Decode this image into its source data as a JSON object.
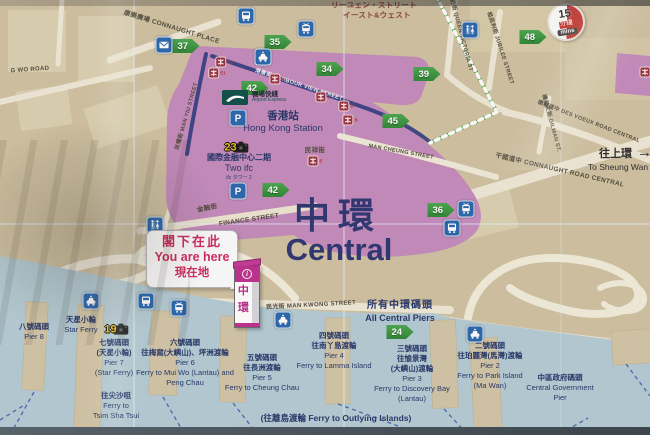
{
  "title": {
    "zh": "中環",
    "en": "Central"
  },
  "you_are_here": {
    "zh": "閣下在此",
    "en": "You are here",
    "jp": "現在地"
  },
  "pillar": {
    "info": "i",
    "char1": "中",
    "char2": "環"
  },
  "sheung_wan": {
    "zh": "往上環",
    "arrow": "→",
    "en": "To Sheung Wan"
  },
  "all_piers": {
    "zh": "所有中環碼頭",
    "en": "All Central Piers"
  },
  "walk_logo": {
    "big": "15",
    "zh": "分鐘",
    "en": "mins"
  },
  "airport_express": {
    "zh": "機場快綫",
    "en": "Airport Express"
  },
  "station": {
    "zh": "香港站",
    "en": "Hong Kong Station"
  },
  "two_ifc": {
    "zh": "國際金融中心二期",
    "en": "Two ifc",
    "jp": "ifc タワー 2"
  },
  "street_labels": [
    {
      "t": "康樂廣場 CONNAUGHT PLACE",
      "x": 172,
      "y": 26,
      "r": 17,
      "s": 6.5
    },
    {
      "t": "リーユェン・ストリート",
      "x": 374,
      "y": 5,
      "r": 0,
      "s": 7.5,
      "cls": "jp"
    },
    {
      "t": "イースト&ウェスト",
      "x": 377,
      "y": 15,
      "r": 0,
      "s": 7.5,
      "cls": "jp"
    },
    {
      "t": "域多利皇后街 QUEEN VICTORIA ST",
      "x": 459,
      "y": 24,
      "r": 75,
      "s": 5.5
    },
    {
      "t": "租庇利街 JUBILEE STREET",
      "x": 501,
      "y": 48,
      "r": 72,
      "s": 5.5
    },
    {
      "t": "德輔道中",
      "x": 578,
      "y": 22,
      "r": 78,
      "s": 5.5
    },
    {
      "t": "德輔道中 DES VOEUX ROAD CENTRAL",
      "x": 589,
      "y": 121,
      "r": 21,
      "s": 5.5
    },
    {
      "t": "機利文街 GILMAN ST.",
      "x": 552,
      "y": 123,
      "r": 75,
      "s": 5.5
    },
    {
      "t": "干諾道中 CONNAUGHT ROAD CENTRAL",
      "x": 560,
      "y": 169,
      "r": 13,
      "s": 6.5
    },
    {
      "t": "港景街 HARBOUR VIEW STREET",
      "x": 299,
      "y": 84,
      "r": 18,
      "s": 5.5,
      "cls": "onband"
    },
    {
      "t": "民耀街 MAN YIU STREET",
      "x": 186,
      "y": 116,
      "r": -74,
      "s": 5.5
    },
    {
      "t": "民祥街",
      "x": 315,
      "y": 149,
      "r": 0,
      "s": 6.5
    },
    {
      "t": "MAN CHEUNG STREET",
      "x": 401,
      "y": 152,
      "r": 10,
      "s": 5.5
    },
    {
      "t": "金融街",
      "x": 207,
      "y": 207,
      "r": -12,
      "s": 6.5
    },
    {
      "t": "FINANCE STREET",
      "x": 249,
      "y": 220,
      "r": -8,
      "s": 6.5
    },
    {
      "t": "民光街 MAN KWONG STREET",
      "x": 311,
      "y": 304,
      "r": -3,
      "s": 6
    },
    {
      "t": "G WO ROAD",
      "x": 30,
      "y": 70,
      "r": -4,
      "s": 6
    }
  ],
  "pier_blocks": [
    {
      "x": 34,
      "y": 322,
      "lines": [
        "八號碼頭",
        "Pier 8"
      ]
    },
    {
      "x": 81,
      "y": 315,
      "lines": [
        "天星小輪",
        "Star Ferry"
      ]
    },
    {
      "x": 114,
      "y": 338,
      "lines": [
        "七號碼頭",
        "(天星小輪)",
        "Pier 7",
        "(Star Ferry)"
      ]
    },
    {
      "x": 185,
      "y": 338,
      "lines": [
        "六號碼頭",
        "往梅窩(大嶼山)、坪洲渡輪",
        "Pier 6",
        "Ferry to Mui Wo (Lantau) and",
        "Peng Chau"
      ]
    },
    {
      "x": 262,
      "y": 353,
      "lines": [
        "五號碼頭",
        "往長洲渡輪",
        "Pier 5",
        "Ferry to Cheung Chau"
      ]
    },
    {
      "x": 334,
      "y": 331,
      "lines": [
        "四號碼頭",
        "往南丫島渡輪",
        "Pier 4",
        "Ferry to Lamma Island"
      ]
    },
    {
      "x": 412,
      "y": 344,
      "lines": [
        "三號碼頭",
        "往愉景灣",
        "(大嶼山)渡輪",
        "Pier 3",
        "Ferry to Discovery Bay",
        "(Lantau)"
      ]
    },
    {
      "x": 490,
      "y": 341,
      "lines": [
        "二號碼頭",
        "往珀麗灣(馬灣)渡輪",
        "Pier 2",
        "Ferry to Park Island",
        "(Ma Wan)"
      ]
    },
    {
      "x": 560,
      "y": 373,
      "lines": [
        "中區政府碼頭",
        "Central Government",
        "Pier"
      ]
    },
    {
      "x": 116,
      "y": 391,
      "lines": [
        "往尖沙咀",
        "Ferry to",
        "Tsim Sha Tsui"
      ]
    },
    {
      "x": 336,
      "y": 413,
      "s": 8.5,
      "lines": [
        "(往離島渡輪 Ferry to Outlying Islands)"
      ]
    }
  ],
  "badges": [
    {
      "n": "35",
      "x": 278,
      "y": 42
    },
    {
      "n": "37",
      "x": 186,
      "y": 46
    },
    {
      "n": "34",
      "x": 330,
      "y": 69
    },
    {
      "n": "39",
      "x": 427,
      "y": 74
    },
    {
      "n": "42",
      "x": 255,
      "y": 88
    },
    {
      "n": "45",
      "x": 396,
      "y": 121
    },
    {
      "n": "42",
      "x": 276,
      "y": 190
    },
    {
      "n": "36",
      "x": 441,
      "y": 210
    },
    {
      "n": "48",
      "x": 533,
      "y": 37
    },
    {
      "n": "24",
      "x": 400,
      "y": 332
    }
  ],
  "icons": [
    {
      "k": "mail",
      "x": 164,
      "y": 45
    },
    {
      "k": "bus",
      "x": 246,
      "y": 16
    },
    {
      "k": "tram",
      "x": 306,
      "y": 29
    },
    {
      "k": "taxi",
      "x": 263,
      "y": 57
    },
    {
      "k": "toilet",
      "x": 470,
      "y": 30
    },
    {
      "k": "parking",
      "x": 238,
      "y": 118
    },
    {
      "k": "parking",
      "x": 238,
      "y": 191
    },
    {
      "k": "toilet",
      "x": 155,
      "y": 225
    },
    {
      "k": "bus",
      "x": 146,
      "y": 301
    },
    {
      "k": "tram",
      "x": 179,
      "y": 308
    },
    {
      "k": "taxi",
      "x": 91,
      "y": 301
    },
    {
      "k": "taxi",
      "x": 283,
      "y": 320
    },
    {
      "k": "taxi",
      "x": 475,
      "y": 334
    },
    {
      "k": "tram",
      "x": 466,
      "y": 209
    },
    {
      "k": "bus",
      "x": 452,
      "y": 228
    }
  ],
  "mtr_exits": [
    {
      "x": 224,
      "y": 62,
      "l": "E2"
    },
    {
      "x": 217,
      "y": 73,
      "l": "E1"
    },
    {
      "x": 277,
      "y": 79,
      "l": "A"
    },
    {
      "x": 323,
      "y": 97,
      "l": "C"
    },
    {
      "x": 346,
      "y": 106,
      "l": "D"
    },
    {
      "x": 350,
      "y": 120,
      "l": "B"
    },
    {
      "x": 315,
      "y": 161,
      "l": "E"
    },
    {
      "x": 645,
      "y": 72,
      "l": ""
    }
  ],
  "photo_spots": [
    {
      "n": "23",
      "x": 237,
      "y": 147
    },
    {
      "n": "19",
      "x": 117,
      "y": 329
    }
  ],
  "palette": {
    "land": "#cfc1a1",
    "road": "#efe8d6",
    "complex_purple": "#c286bd",
    "sea": "#b4cbd4",
    "badge_green": "#2e8634",
    "icon_blue": "#2a66ae",
    "mtr_red": "#9a2f3f",
    "navy_text": "#233569",
    "title_navy": "#2d3472",
    "marker_magenta": "#bd2f8e",
    "bubble_red": "#d02a60",
    "rail_blue": "#2f3b80",
    "tram_green": "#46a13c"
  }
}
